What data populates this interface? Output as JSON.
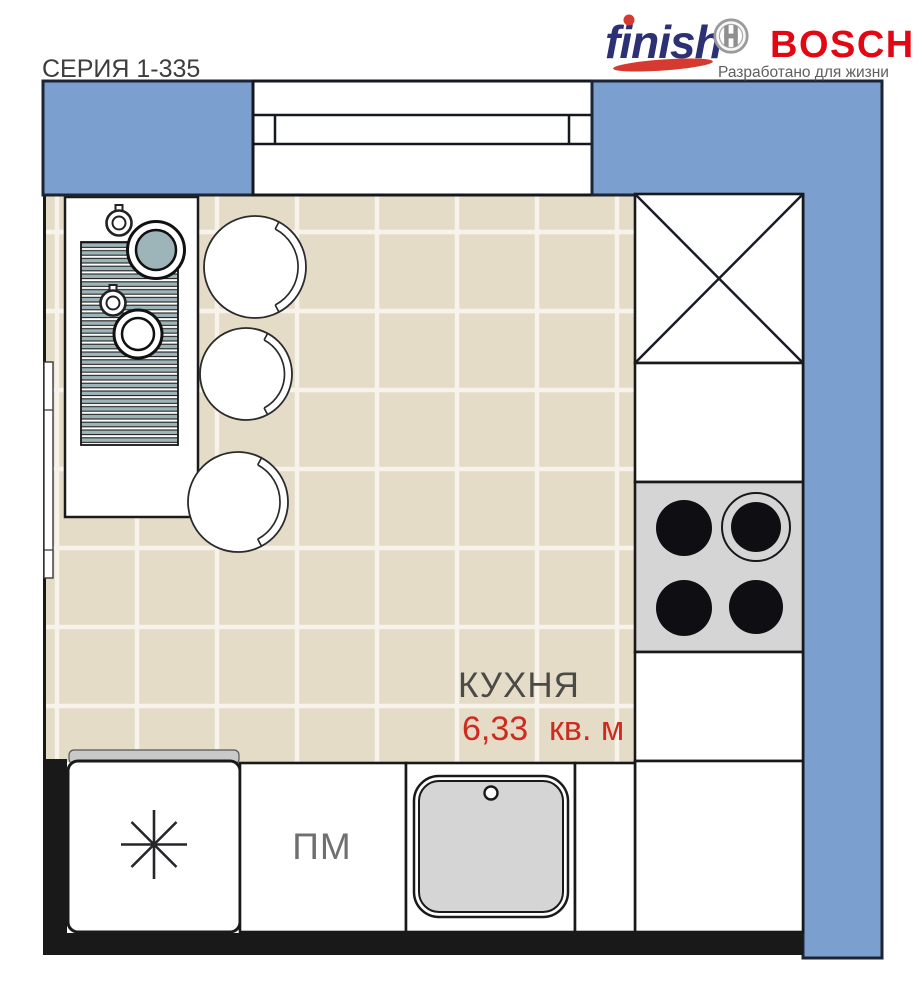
{
  "header": {
    "series_label": "СЕРИЯ 1-335",
    "finish_logo_text": "finish",
    "bosch_logo_text": "BOSCH",
    "bosch_tagline": "Разработано для жизни"
  },
  "room": {
    "name": "КУХНЯ",
    "area_value": "6,33",
    "area_unit": "кв. м"
  },
  "appliances": {
    "dishwasher_label": "ПМ"
  },
  "symbols": {
    "fridge_icon": "asterisk-snowflake",
    "vent_icon": "crossed-box",
    "hob_icon": "four-burner-hob",
    "sink_icon": "basin-with-drain-hole",
    "bosch_emblem_icon": "circle-h",
    "dining_icon": "table-with-runner-plates-cups",
    "chair_icon": "round-chair-with-backrest"
  },
  "colors": {
    "wall-blue": "#7ba0cf",
    "wall-border": "#1d2433",
    "floor": "#e5dcc8",
    "grid": "#f7f3ea",
    "line-black": "#191919",
    "appliance-gray": "#d5d5d5",
    "fridge-top-gray": "#c9c9c9",
    "burner-black": "#0e0e13",
    "stripe-teal": "#9db4b9",
    "accent-red": "#cf2a1f",
    "bosch-red": "#e30613",
    "finish-navy": "#2b3173",
    "swoosh-red": "#d6392f",
    "text-dark": "#3d3d3d",
    "text-gray": "#6f6f6f",
    "tagline-gray": "#5f5f5f",
    "room-label": "#4a4a46",
    "emblem-gray": "#8f8f8f"
  }
}
